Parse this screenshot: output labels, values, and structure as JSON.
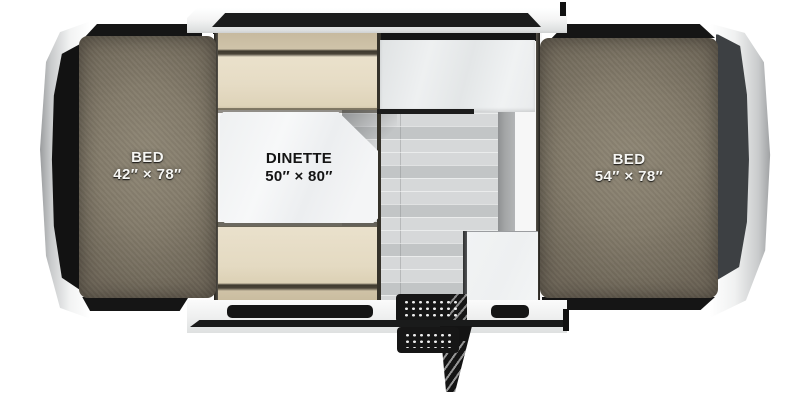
{
  "title": "Pop-up camper floor plan",
  "labels": {
    "left_bed": {
      "name": "BED",
      "size": "42″ × 78″"
    },
    "dinette": {
      "name": "DINETTE",
      "size": "50″ × 80″"
    },
    "right_bed": {
      "name": "BED",
      "size": "54″ × 78″"
    }
  },
  "colors": {
    "mattress": "#847c6b",
    "mattress-dark": "#6d6557",
    "bench": "#e6dcc5",
    "bench-dark": "#c9bc9f",
    "table": "#f4f5f6",
    "counter": "#e9ebec",
    "cabinet": "#eef0f1",
    "floor": "#d6d8d9",
    "galley": "#a3a5a6",
    "trim-black": "#151515",
    "body-white": "#f4f5f5",
    "cap-shade": "#9a9c9e",
    "right-panel": "#3d4043"
  }
}
